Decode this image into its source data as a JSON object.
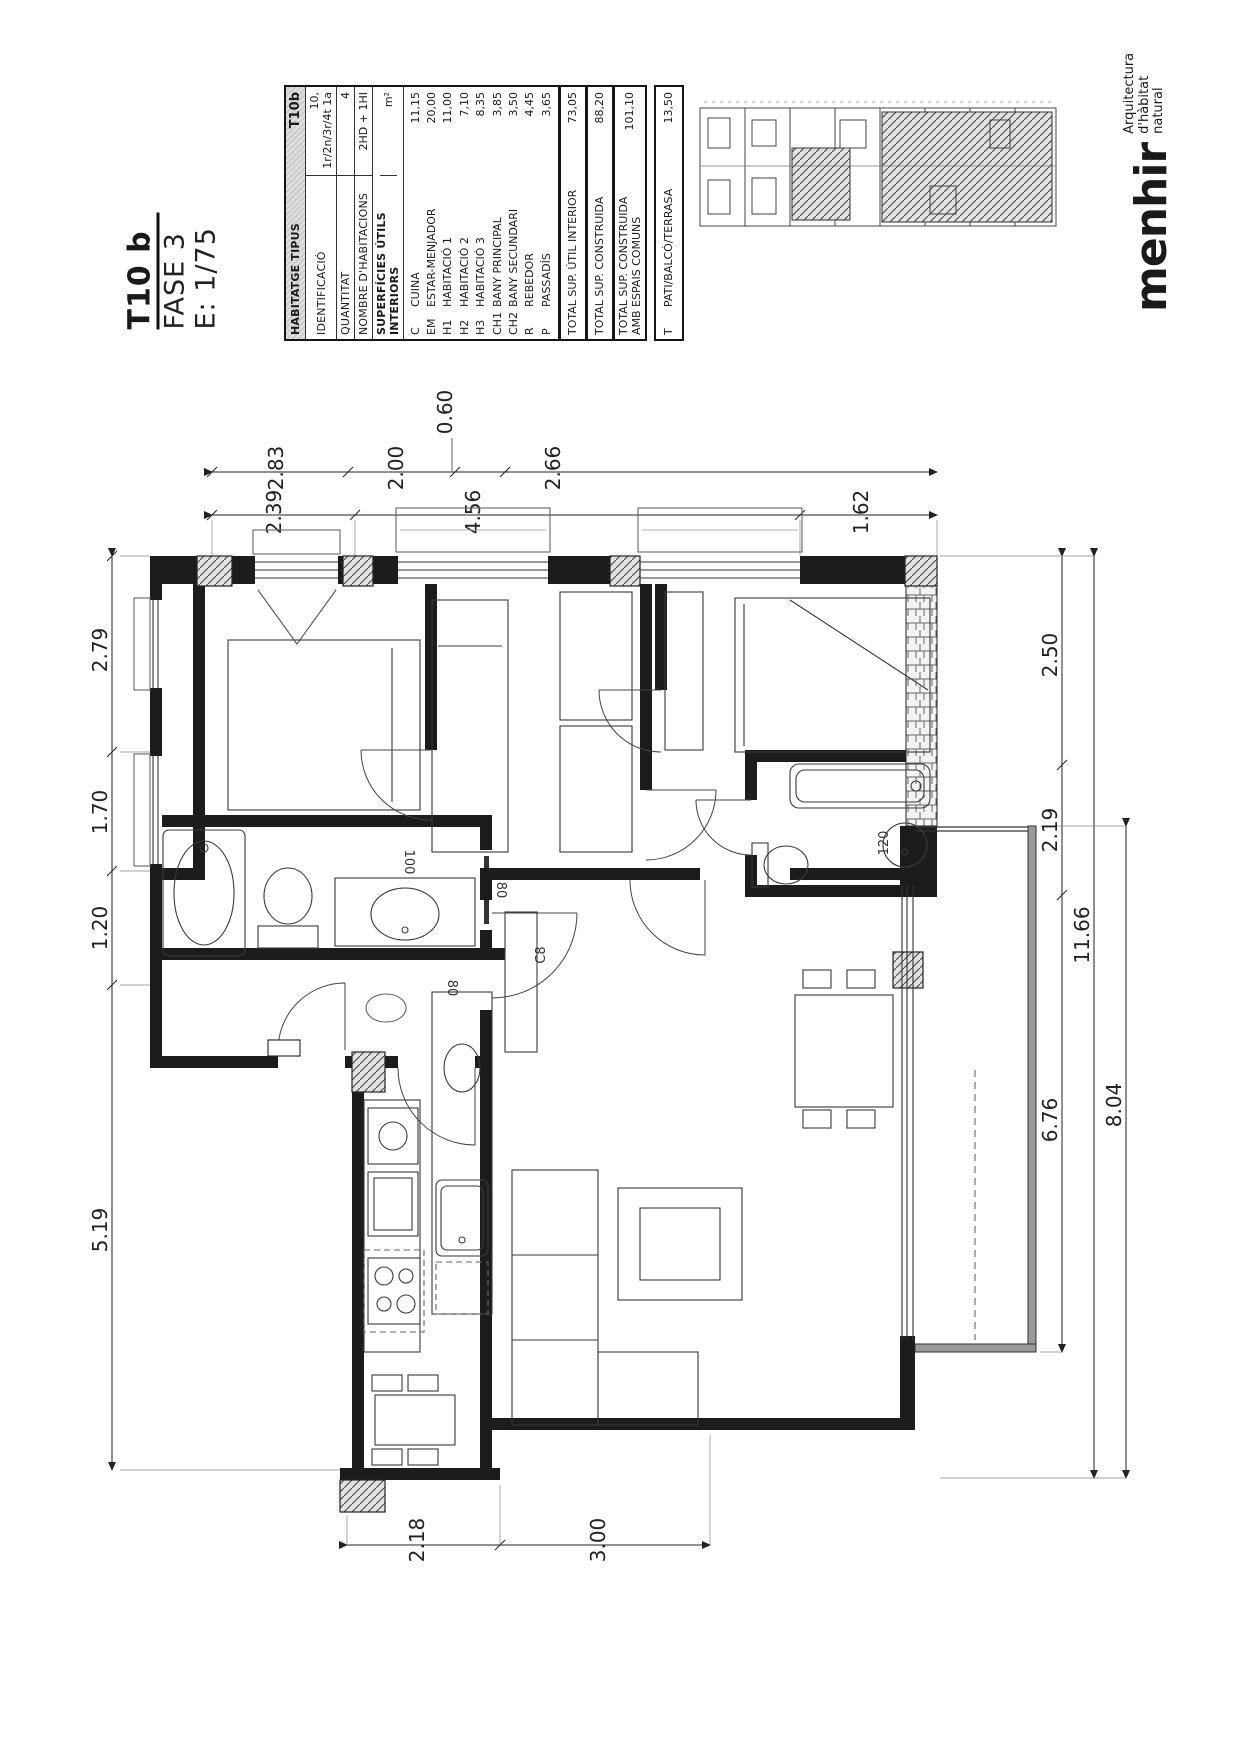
{
  "title": {
    "code": "T10 b",
    "phase": "FASE 3",
    "scale": "E: 1/75"
  },
  "table": {
    "header": {
      "label": "HABITATGE TIPUS",
      "value": "T10b"
    },
    "info": [
      {
        "label": "IDENTIFICACIÓ",
        "value": "10, 1r/2n/3r/4t 1a"
      },
      {
        "label": "QUANTITAT",
        "value": "4"
      },
      {
        "label": "NOMBRE D'HABITACIONS",
        "value": "2HD + 1HI"
      }
    ],
    "surfaces_header": {
      "label": "SUPERFÍCIES ÚTILS INTERIORS",
      "value": "m²"
    },
    "rooms": [
      {
        "code": "C",
        "name": "CUINA",
        "value": "11,15"
      },
      {
        "code": "EM",
        "name": "ESTAR-MENJADOR",
        "value": "20,00"
      },
      {
        "code": "H1",
        "name": "HABITACIÓ 1",
        "value": "11,00"
      },
      {
        "code": "H2",
        "name": "HABITACIÓ 2",
        "value": "7,10"
      },
      {
        "code": "H3",
        "name": "HABITACIÓ 3",
        "value": "8,35"
      },
      {
        "code": "CH1",
        "name": "BANY PRINCIPAL",
        "value": "3,85"
      },
      {
        "code": "CH2",
        "name": "BANY SECUNDARI",
        "value": "3,50"
      },
      {
        "code": "R",
        "name": "REBEDOR",
        "value": "4,45"
      },
      {
        "code": "P",
        "name": "PASSADÍS",
        "value": "3,65"
      }
    ],
    "totals": [
      {
        "label": "TOTAL SUP. ÚTIL INTERIOR",
        "value": "73,05"
      },
      {
        "label": "TOTAL SUP. CONSTRUIDA",
        "value": "88,20"
      },
      {
        "label": "TOTAL SUP. CONSTRUIDA AMB ESPAIS COMUNS",
        "value": "101,10"
      }
    ],
    "terrace": {
      "code": "T",
      "label": "PATI/BALCÓ/TERRASA",
      "value": "13,50"
    }
  },
  "logo": {
    "name": "menhir",
    "tagline1": "Arquitectura",
    "tagline2": "d'hàbitat natural"
  },
  "dims": {
    "top1": [
      "2.83",
      "2.00",
      "0.60",
      "2.66"
    ],
    "top2": [
      "2.39",
      "4.56",
      "1.62"
    ],
    "left": [
      "2.79",
      "1.70",
      "1.20",
      "5.19"
    ],
    "right": [
      "2.50",
      "2.19",
      "6.76",
      "11.66",
      "8.04"
    ],
    "bottom": [
      "2.18",
      "3.00"
    ],
    "plan_labels": [
      "80",
      "100",
      "C8",
      "80",
      "120"
    ]
  }
}
